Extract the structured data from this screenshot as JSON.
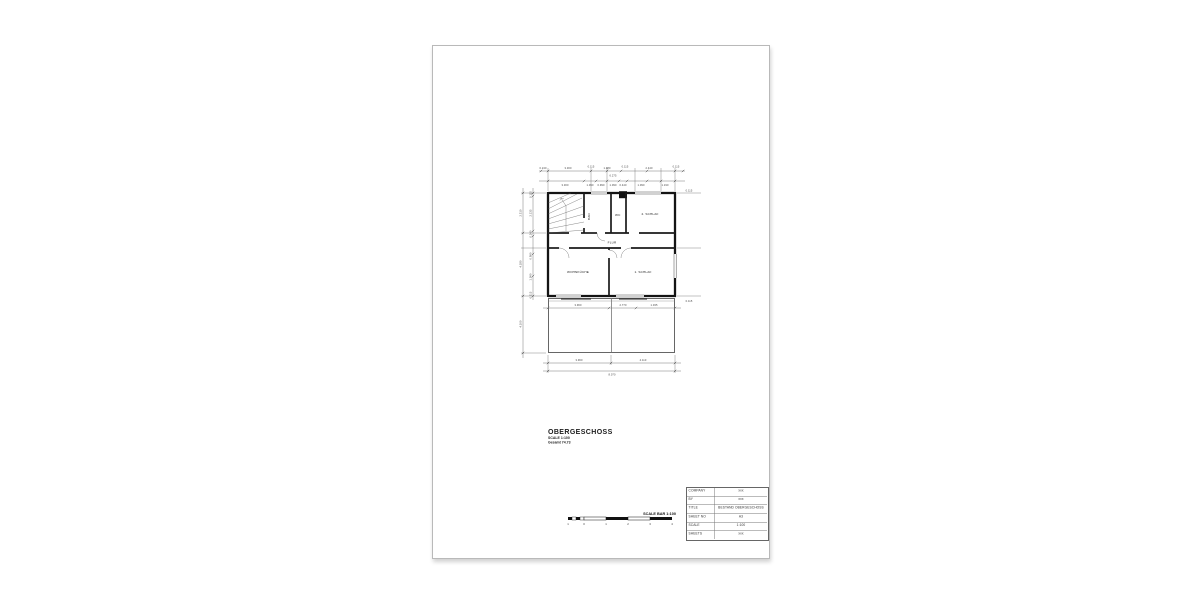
{
  "colors": {
    "ink": "#1a1a1a",
    "sheet_border": "#b9b9b9"
  },
  "drawing_title": {
    "title": "OBERGESCHOSS",
    "scale_note": "SCALE 1:100",
    "area_note": "Gesamt 74.73"
  },
  "scale_bar": {
    "label": "SCALE BAR 1:100",
    "ticks": [
      "1",
      "0",
      "1",
      "2",
      "3",
      "4"
    ]
  },
  "title_block": {
    "rows": [
      {
        "label": "COMPANY",
        "value": "xxx"
      },
      {
        "label": "BY",
        "value": "xxx"
      },
      {
        "label": "TITLE",
        "value": "BESTAND OBERGESCHOSS"
      },
      {
        "label": "SHEET NO",
        "value": "A3"
      },
      {
        "label": "SCALE",
        "value": "1:100"
      },
      {
        "label": "SHEETS",
        "value": "xxx"
      }
    ]
  },
  "plan": {
    "rooms": {
      "bath": "BAD",
      "wc": "WC",
      "bedroom2": "2. SCHLAF",
      "hall": "FLUR",
      "kitchen": "WOHNKÜCHE",
      "bedroom1": "1. SCHLAF"
    },
    "dims": {
      "top_row1": [
        "0.240",
        "3.300",
        "0.115",
        "1.980",
        "0.115",
        "2.440",
        "0.115"
      ],
      "top_total": "6.275",
      "top_row2": [
        "3.300",
        "1.090",
        "0.990",
        "1.090",
        "0.440",
        "1.090",
        "1.190"
      ],
      "left_outer": [
        "2.310",
        "4.180",
        "4.100"
      ],
      "left_inner": [
        "0.115",
        "2.135",
        "0.240",
        "0.990",
        "1.090",
        "0.115"
      ],
      "inner_bottom": [
        "3.960",
        "2.770",
        "1.035"
      ],
      "bottom_segments": [
        "3.960",
        "4.110"
      ],
      "bottom_total": "8.070",
      "right": [
        "0.115",
        "0.115"
      ]
    }
  }
}
